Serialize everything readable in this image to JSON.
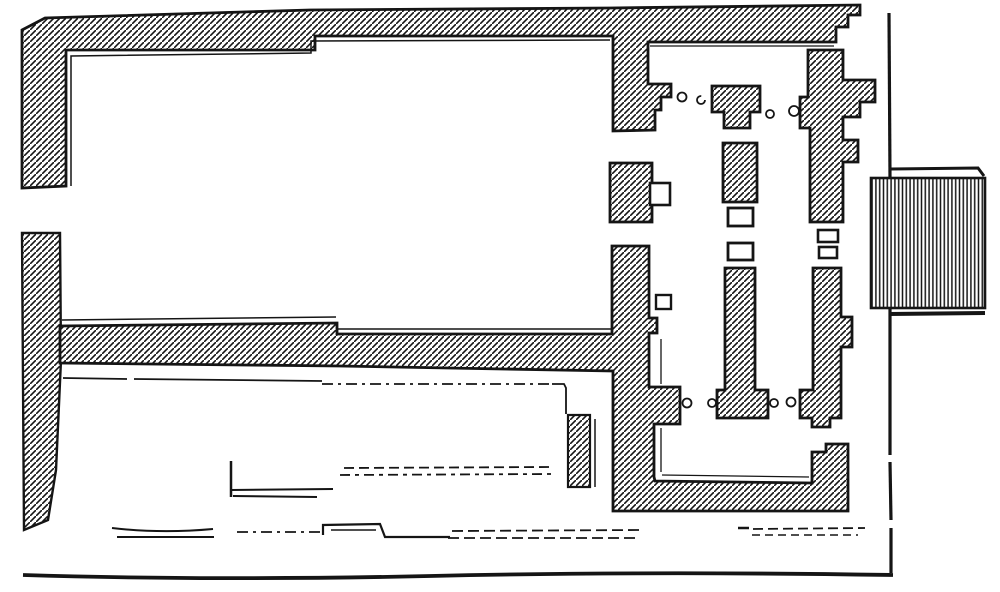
{
  "figure": {
    "kind": "engraved-architectural-floor-plan",
    "canvas": {
      "width": 1000,
      "height": 592,
      "background": "#ffffff",
      "ink": "#151515"
    },
    "patterns": {
      "wall_hatch": {
        "style": "diagonal-lines",
        "direction": "/",
        "spacing": 6,
        "stroke_width": 1.6
      },
      "platform_stripes": {
        "style": "vertical-lines",
        "spacing": 3.8,
        "stroke_width": 1.5
      }
    }
  },
  "plan": {
    "hatched_walls": [
      {
        "name": "north-enclosure-wall",
        "stroke_width": 2.8,
        "points": [
          [
            22,
            30
          ],
          [
            45,
            18
          ],
          [
            310,
            10
          ],
          [
            610,
            8
          ],
          [
            860,
            5
          ],
          [
            860,
            15
          ],
          [
            848,
            15
          ],
          [
            848,
            27
          ],
          [
            836,
            27
          ],
          [
            836,
            42
          ],
          [
            648,
            42
          ],
          [
            648,
            84
          ],
          [
            671,
            84
          ],
          [
            671,
            97
          ],
          [
            661,
            97
          ],
          [
            661,
            110
          ],
          [
            655,
            110
          ],
          [
            655,
            130
          ],
          [
            613,
            131
          ],
          [
            613,
            36
          ],
          [
            315,
            36
          ],
          [
            315,
            50
          ],
          [
            66,
            50
          ],
          [
            66,
            186
          ],
          [
            22,
            188
          ]
        ]
      },
      {
        "name": "west-wall-lower-segment",
        "stroke_width": 2.4,
        "points": [
          [
            22,
            233
          ],
          [
            60,
            233
          ],
          [
            61,
            360
          ],
          [
            56,
            470
          ],
          [
            48,
            520
          ],
          [
            24,
            530
          ]
        ]
      },
      {
        "name": "mid-wall-and-inner-court-wall",
        "stroke_width": 2.8,
        "points": [
          [
            613,
            246
          ],
          [
            649,
            246
          ],
          [
            649,
            318
          ],
          [
            657,
            318
          ],
          [
            657,
            333
          ],
          [
            649,
            333
          ],
          [
            649,
            387
          ],
          [
            680,
            387
          ],
          [
            680,
            424
          ],
          [
            654,
            424
          ],
          [
            654,
            477
          ],
          [
            655,
            481
          ],
          [
            812,
            483
          ],
          [
            812,
            452
          ],
          [
            826,
            452
          ],
          [
            826,
            444
          ],
          [
            848,
            444
          ],
          [
            848,
            511
          ],
          [
            613,
            511
          ],
          [
            613,
            371
          ],
          [
            340,
            366
          ],
          [
            60,
            363
          ],
          [
            60,
            326
          ],
          [
            337,
            323
          ],
          [
            337,
            334
          ],
          [
            612,
            334
          ],
          [
            612,
            246
          ]
        ]
      },
      {
        "name": "court-west-block",
        "stroke_width": 2.8,
        "points": [
          [
            610,
            163
          ],
          [
            652,
            163
          ],
          [
            652,
            222
          ],
          [
            610,
            222
          ]
        ]
      },
      {
        "name": "central-north-structure",
        "stroke_width": 2.8,
        "points": [
          [
            712,
            86
          ],
          [
            760,
            86
          ],
          [
            760,
            112
          ],
          [
            750,
            112
          ],
          [
            750,
            128
          ],
          [
            724,
            128
          ],
          [
            724,
            112
          ],
          [
            712,
            112
          ]
        ]
      },
      {
        "name": "central-mid-pedestal",
        "stroke_width": 2.8,
        "points": [
          [
            723,
            143
          ],
          [
            757,
            143
          ],
          [
            757,
            202
          ],
          [
            723,
            202
          ]
        ]
      },
      {
        "name": "central-long-pedestal",
        "stroke_width": 2.8,
        "points": [
          [
            725,
            268
          ],
          [
            755,
            268
          ],
          [
            755,
            390
          ],
          [
            768,
            390
          ],
          [
            768,
            418
          ],
          [
            717,
            418
          ],
          [
            717,
            390
          ],
          [
            725,
            390
          ]
        ]
      },
      {
        "name": "east-cross-structure",
        "stroke_width": 2.8,
        "points": [
          [
            808,
            50
          ],
          [
            843,
            50
          ],
          [
            843,
            80
          ],
          [
            875,
            80
          ],
          [
            875,
            102
          ],
          [
            860,
            102
          ],
          [
            860,
            117
          ],
          [
            843,
            117
          ],
          [
            843,
            140
          ],
          [
            858,
            140
          ],
          [
            858,
            162
          ],
          [
            843,
            162
          ],
          [
            843,
            222
          ],
          [
            810,
            222
          ],
          [
            810,
            128
          ],
          [
            800,
            128
          ],
          [
            800,
            97
          ],
          [
            808,
            97
          ]
        ]
      },
      {
        "name": "east-lower-structure",
        "stroke_width": 2.8,
        "points": [
          [
            813,
            268
          ],
          [
            841,
            268
          ],
          [
            841,
            317
          ],
          [
            852,
            317
          ],
          [
            852,
            347
          ],
          [
            841,
            347
          ],
          [
            841,
            418
          ],
          [
            830,
            418
          ],
          [
            830,
            427
          ],
          [
            812,
            427
          ],
          [
            812,
            418
          ],
          [
            800,
            418
          ],
          [
            800,
            390
          ],
          [
            813,
            390
          ]
        ]
      },
      {
        "name": "south-court-wall-strip",
        "stroke_width": 2.2,
        "points": [
          [
            568,
            415
          ],
          [
            590,
            415
          ],
          [
            590,
            487
          ],
          [
            568,
            487
          ]
        ]
      }
    ],
    "grid_block": {
      "name": "striped-platform-annex",
      "x": 871,
      "y": 178,
      "w": 114,
      "h": 130,
      "stroke_width": 2.6
    },
    "open_features": [
      {
        "name": "annex-square-west-block",
        "x": 650,
        "y": 183,
        "w": 20,
        "h": 22,
        "stroke_width": 2.6
      },
      {
        "name": "small-square-west-wall",
        "x": 656,
        "y": 295,
        "w": 15,
        "h": 14,
        "stroke_width": 2.4
      },
      {
        "name": "central-square-upper",
        "x": 728,
        "y": 208,
        "w": 25,
        "h": 18,
        "stroke_width": 2.8
      },
      {
        "name": "central-square-lower",
        "x": 728,
        "y": 243,
        "w": 25,
        "h": 17,
        "stroke_width": 2.8
      },
      {
        "name": "east-square-upper",
        "x": 818,
        "y": 230,
        "w": 20,
        "h": 12,
        "stroke_width": 2.6
      },
      {
        "name": "east-square-lower",
        "x": 819,
        "y": 247,
        "w": 18,
        "h": 11,
        "stroke_width": 2.6
      }
    ],
    "circles": [
      {
        "name": "column-base",
        "cx": 682,
        "cy": 97,
        "r": 4.5,
        "partial": false
      },
      {
        "name": "column-base-broken",
        "cx": 701,
        "cy": 100,
        "r": 4.0,
        "partial": true
      },
      {
        "name": "column-base",
        "cx": 770,
        "cy": 114,
        "r": 4.0,
        "partial": false
      },
      {
        "name": "column-base",
        "cx": 794,
        "cy": 111,
        "r": 5.0,
        "partial": false
      },
      {
        "name": "column-base",
        "cx": 687,
        "cy": 403,
        "r": 4.5,
        "partial": false
      },
      {
        "name": "column-base",
        "cx": 712,
        "cy": 403,
        "r": 4.0,
        "partial": false
      },
      {
        "name": "column-base",
        "cx": 774,
        "cy": 403,
        "r": 4.0,
        "partial": false
      },
      {
        "name": "column-base",
        "cx": 791,
        "cy": 402,
        "r": 4.5,
        "partial": false
      }
    ],
    "lines": [
      {
        "name": "north-room-inner-ledge",
        "d": "M 71,186 L 71,56 L 311,53 L 311,41 L 610,40",
        "w": 1.5
      },
      {
        "name": "court-north-inner-ledge",
        "d": "M 650,46 L 834,46",
        "w": 1.3
      },
      {
        "name": "mid-wall-upper-ledge-west",
        "d": "M 62,320 L 336,317",
        "w": 1.5
      },
      {
        "name": "mid-wall-upper-ledge-east",
        "d": "M 338,329 L 611,329",
        "w": 1.5
      },
      {
        "name": "court-west-inner-ledge-a",
        "d": "M 661,339 L 661,384",
        "w": 1.3
      },
      {
        "name": "court-west-inner-ledge-b",
        "d": "M 661,428 L 661,472",
        "w": 1.3
      },
      {
        "name": "court-south-inner-ledge",
        "d": "M 662,475 L 809,477",
        "w": 1.3
      },
      {
        "name": "south-enclosure-top-line-a",
        "d": "M 63,378 L 127,379",
        "w": 1.8
      },
      {
        "name": "south-enclosure-top-line-b",
        "d": "M 134,379 L 322,381",
        "w": 1.8
      },
      {
        "name": "south-enclosure-top-dashdot",
        "d": "M 322,384 L 552,384",
        "w": 1.8,
        "dash": "11 5 3 5"
      },
      {
        "name": "south-enclosure-corner",
        "d": "M 552,384 L 564,384 L 566,388 L 566,414",
        "w": 1.8
      },
      {
        "name": "strip-east-line",
        "d": "M 595,419 L 595,487",
        "w": 1.5
      },
      {
        "name": "ruin-L-vertical",
        "d": "M 231,461 L 231,497",
        "w": 2.5
      },
      {
        "name": "ruin-L-horizontal-a",
        "d": "M 231,490 L 333,489",
        "w": 2.0
      },
      {
        "name": "ruin-L-horizontal-b",
        "d": "M 233,496 L 317,497",
        "w": 2.0
      },
      {
        "name": "ruin-dash-row1-a",
        "d": "M 344,468 L 551,467",
        "w": 1.8,
        "dash": "10 5"
      },
      {
        "name": "ruin-dash-row1-b",
        "d": "M 340,475 L 552,474",
        "w": 1.8,
        "dash": "10 5 4 5"
      },
      {
        "name": "ruin-platform-west-a",
        "d": "M 112,528 C 146,532 180,532 213,529",
        "w": 2.0
      },
      {
        "name": "ruin-platform-west-b",
        "d": "M 117,537 L 214,537",
        "w": 2.0
      },
      {
        "name": "ruin-dashdot-mid",
        "d": "M 237,532 L 320,532",
        "w": 1.8,
        "dash": "11 5 3 5"
      },
      {
        "name": "ruin-platform-step",
        "d": "M 323,535 L 323,525 L 380,524 L 385,537 L 450,537",
        "w": 2.2
      },
      {
        "name": "ruin-platform-step-inner",
        "d": "M 331,530 L 376,530",
        "w": 1.4
      },
      {
        "name": "ruin-dash-row2-a",
        "d": "M 452,531 L 640,530",
        "w": 1.8,
        "dash": "11 5"
      },
      {
        "name": "ruin-dash-row2-b",
        "d": "M 448,538 L 636,538",
        "w": 1.8,
        "dash": "11 5"
      },
      {
        "name": "ruin-dash-row3-start",
        "d": "M 738,528 L 749,528",
        "w": 2.5
      },
      {
        "name": "ruin-dash-row3-a",
        "d": "M 753,529 L 865,528",
        "w": 1.8,
        "dash": "10 5"
      },
      {
        "name": "ruin-dash-row3-b",
        "d": "M 752,535 L 858,535",
        "w": 1.6,
        "dash": "8 5"
      },
      {
        "name": "annex-connector-top",
        "d": "M 891,169 L 978,168 L 984,176",
        "w": 3.0
      },
      {
        "name": "annex-connector-bottom",
        "d": "M 889,314 L 985,313",
        "w": 4.0
      },
      {
        "name": "east-boundary-1",
        "d": "M 889,13 L 890,178",
        "w": 3.2
      },
      {
        "name": "east-boundary-2",
        "d": "M 890,308 L 890,455",
        "w": 3.2
      },
      {
        "name": "east-boundary-3",
        "d": "M 890,462 L 891,520",
        "w": 3.2
      },
      {
        "name": "east-boundary-4",
        "d": "M 891,528 L 891,573",
        "w": 3.2
      },
      {
        "name": "south-boundary",
        "d": "M 23,575 C 150,579 300,579 430,576 C 560,573 700,572 893,575",
        "w": 3.8
      }
    ]
  }
}
